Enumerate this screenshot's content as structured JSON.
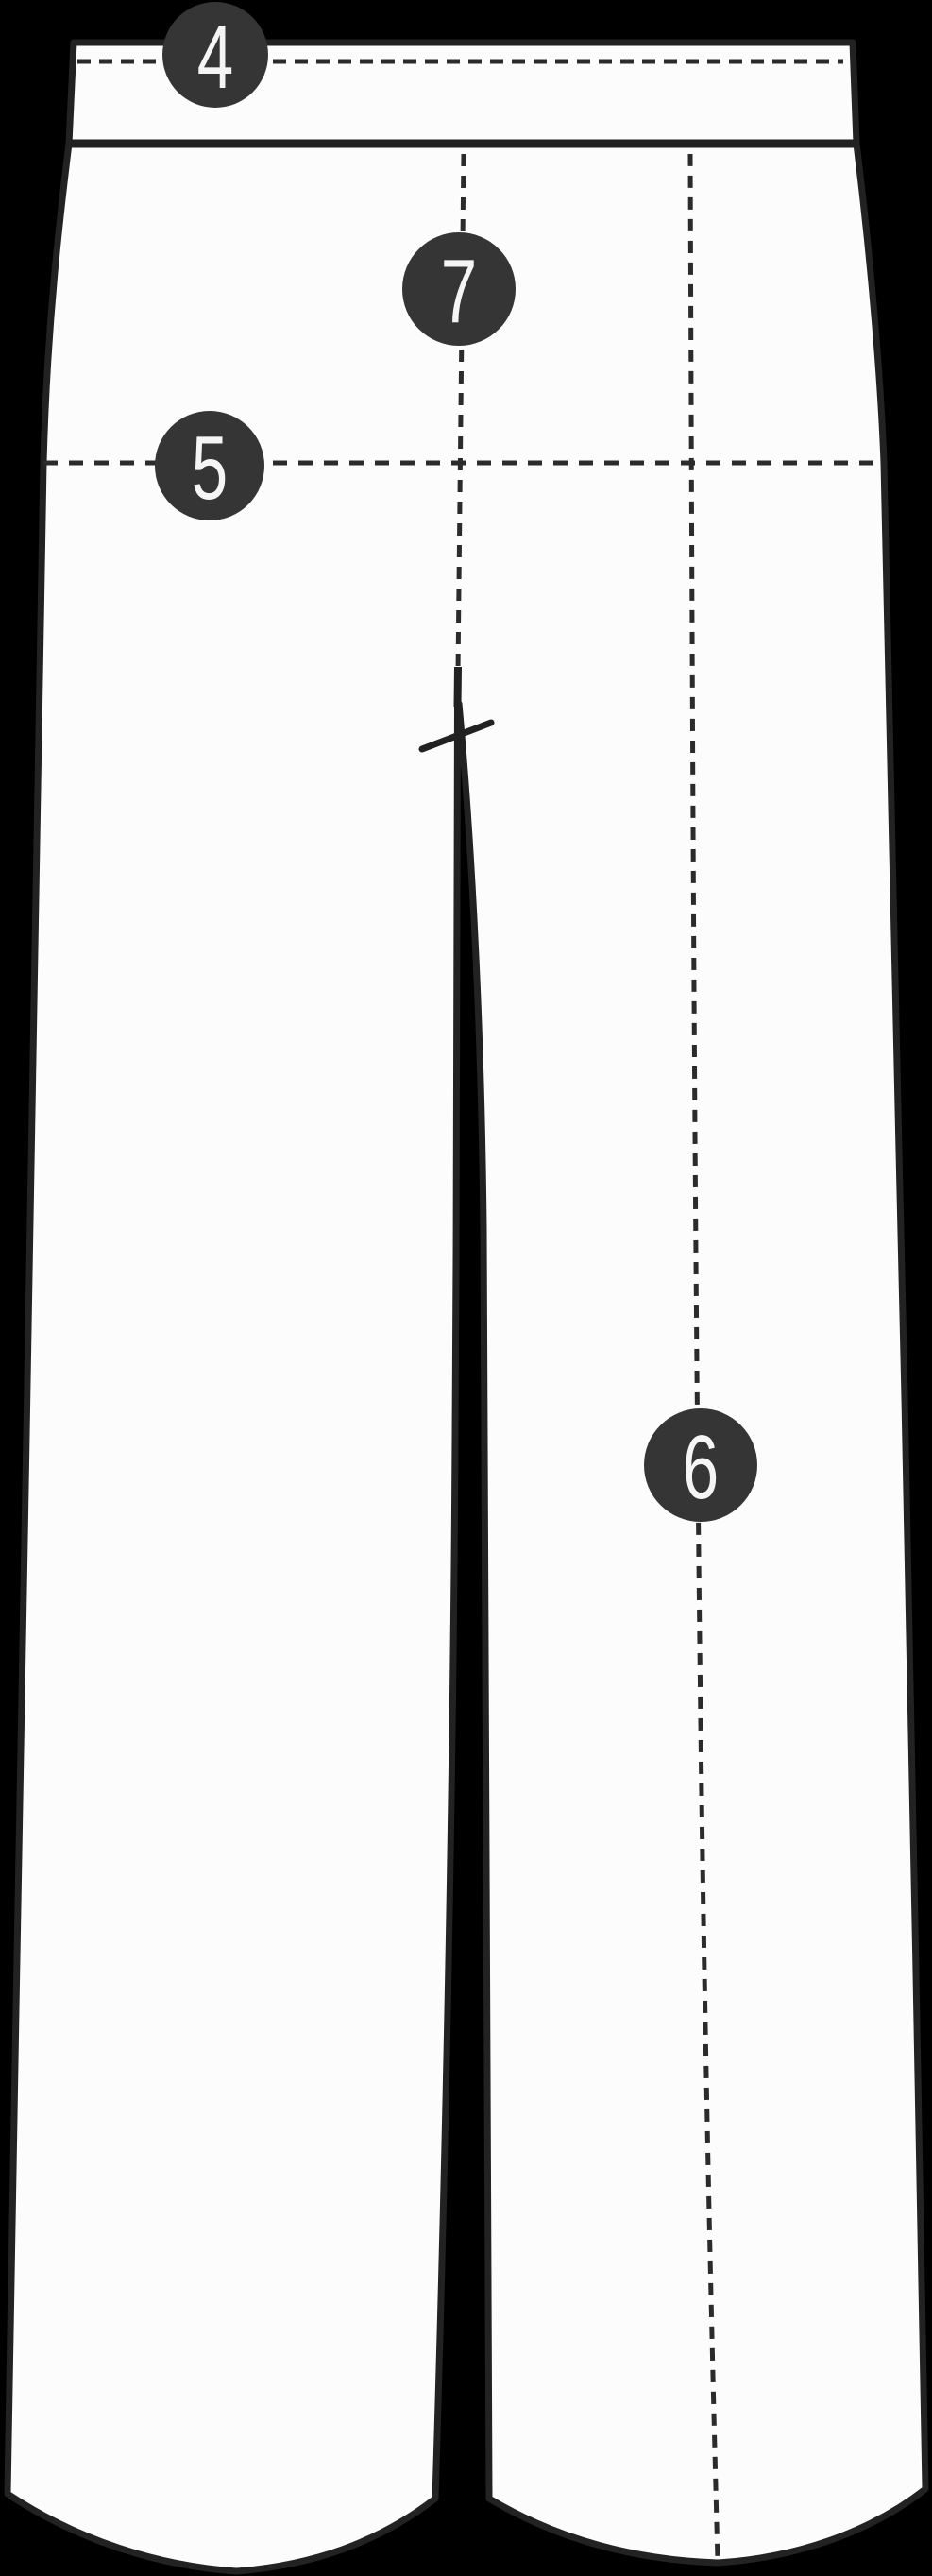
{
  "diagram": {
    "kind": "trousers-size-guide-sketch",
    "view": "flat front view, wide-leg trousers"
  },
  "colors": {
    "background": "#000000",
    "garment_fill": "#fcfcfc",
    "outline": "#222222",
    "seam_line": "#2b2b2b",
    "marker_fill": "#353535",
    "marker_text": "#f5f5f5"
  },
  "markers": [
    {
      "label": "4"
    },
    {
      "label": "5"
    },
    {
      "label": "6"
    },
    {
      "label": "7"
    }
  ]
}
